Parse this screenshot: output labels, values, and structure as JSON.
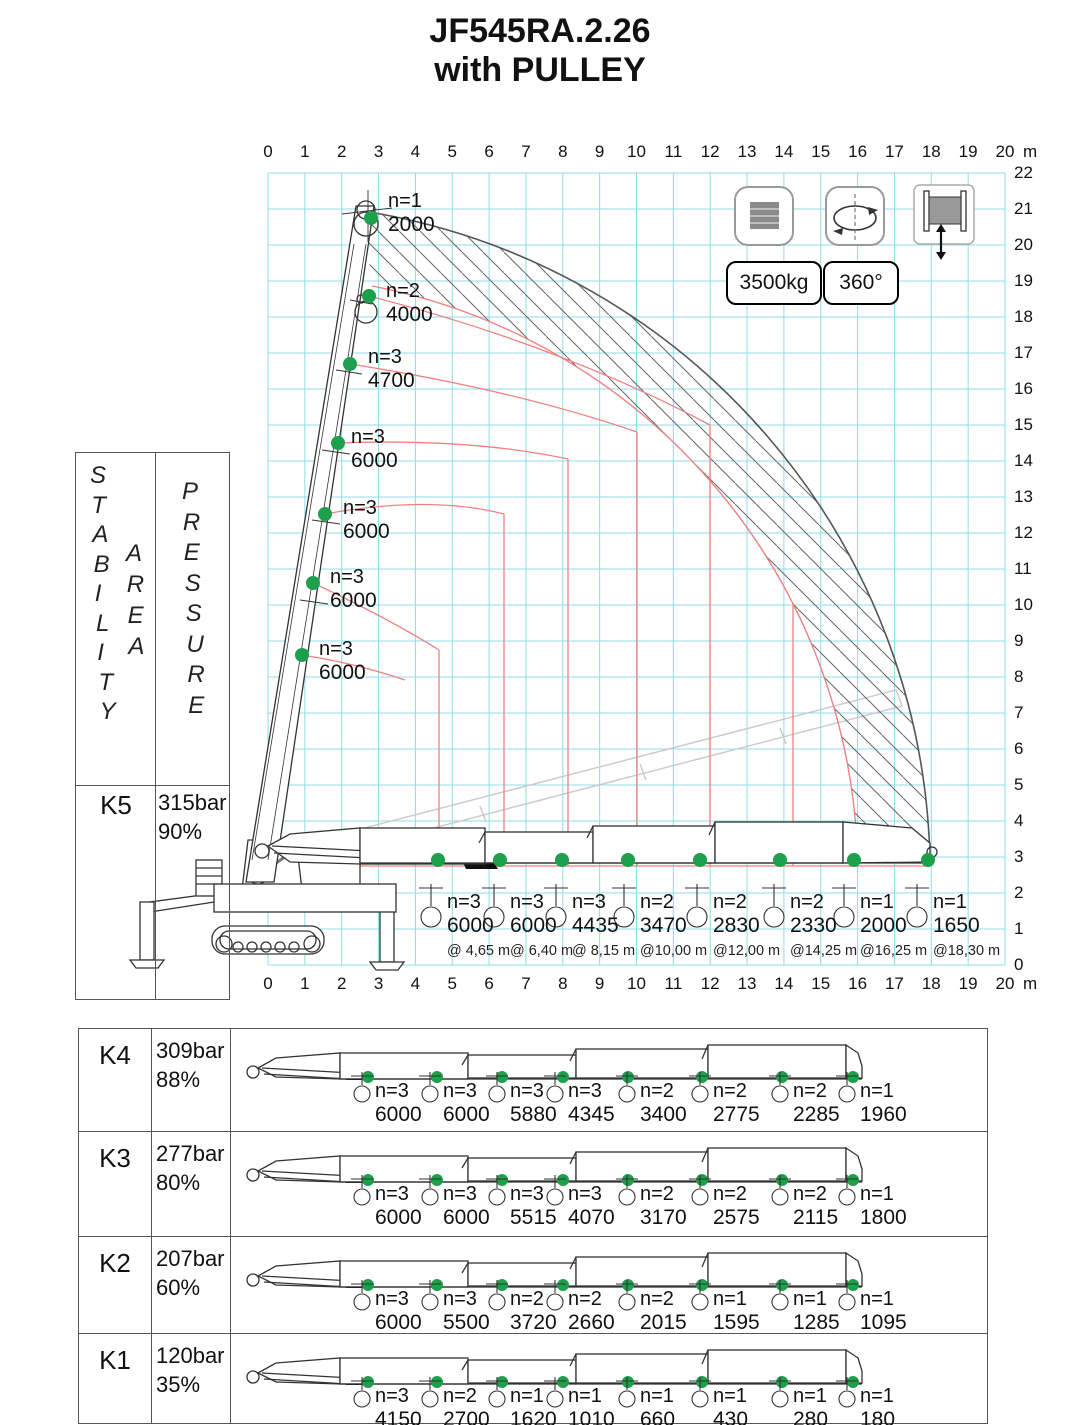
{
  "title": {
    "line1": "JF545RA.2.26",
    "line2": "with PULLEY"
  },
  "badges": {
    "capacity": "3500kg",
    "rotation": "360°"
  },
  "icons": [
    "counterweight-icon",
    "rotation-360-icon",
    "winch-pulley-icon"
  ],
  "axis": {
    "x_unit": "m",
    "x_ticks": [
      "0",
      "1",
      "2",
      "3",
      "4",
      "5",
      "6",
      "7",
      "8",
      "9",
      "10",
      "11",
      "12",
      "13",
      "14",
      "15",
      "16",
      "17",
      "18",
      "19",
      "20"
    ],
    "y_ticks": [
      "0",
      "1",
      "2",
      "3",
      "4",
      "5",
      "6",
      "7",
      "8",
      "9",
      "10",
      "11",
      "12",
      "13",
      "14",
      "15",
      "16",
      "17",
      "18",
      "19",
      "20",
      "21",
      "22"
    ]
  },
  "side_header": {
    "stability": "STABILITY",
    "area": "AREA",
    "pressure": "PRESSURE"
  },
  "vertical_boom_loads": [
    {
      "n": "n=1",
      "load": "2000"
    },
    {
      "n": "n=2",
      "load": "4000"
    },
    {
      "n": "n=3",
      "load": "4700"
    },
    {
      "n": "n=3",
      "load": "6000"
    },
    {
      "n": "n=3",
      "load": "6000"
    },
    {
      "n": "n=3",
      "load": "6000"
    },
    {
      "n": "n=3",
      "load": "6000"
    }
  ],
  "stability_rows": [
    {
      "key": "K5",
      "pressure": "315bar",
      "percent": "90%",
      "loads": [
        {
          "n": "n=3",
          "load": "6000",
          "radius": "@ 4,65 m"
        },
        {
          "n": "n=3",
          "load": "6000",
          "radius": "@ 6,40 m"
        },
        {
          "n": "n=3",
          "load": "4435",
          "radius": "@ 8,15 m"
        },
        {
          "n": "n=2",
          "load": "3470",
          "radius": "@10,00 m"
        },
        {
          "n": "n=2",
          "load": "2830",
          "radius": "@12,00 m"
        },
        {
          "n": "n=2",
          "load": "2330",
          "radius": "@14,25 m"
        },
        {
          "n": "n=1",
          "load": "2000",
          "radius": "@16,25 m"
        },
        {
          "n": "n=1",
          "load": "1650",
          "radius": "@18,30 m"
        }
      ]
    },
    {
      "key": "K4",
      "pressure": "309bar",
      "percent": "88%",
      "loads": [
        {
          "n": "n=3",
          "load": "6000"
        },
        {
          "n": "n=3",
          "load": "6000"
        },
        {
          "n": "n=3",
          "load": "5880"
        },
        {
          "n": "n=3",
          "load": "4345"
        },
        {
          "n": "n=2",
          "load": "3400"
        },
        {
          "n": "n=2",
          "load": "2775"
        },
        {
          "n": "n=2",
          "load": "2285"
        },
        {
          "n": "n=1",
          "load": "1960"
        }
      ]
    },
    {
      "key": "K3",
      "pressure": "277bar",
      "percent": "80%",
      "loads": [
        {
          "n": "n=3",
          "load": "6000"
        },
        {
          "n": "n=3",
          "load": "6000"
        },
        {
          "n": "n=3",
          "load": "5515"
        },
        {
          "n": "n=3",
          "load": "4070"
        },
        {
          "n": "n=2",
          "load": "3170"
        },
        {
          "n": "n=2",
          "load": "2575"
        },
        {
          "n": "n=2",
          "load": "2115"
        },
        {
          "n": "n=1",
          "load": "1800"
        }
      ]
    },
    {
      "key": "K2",
      "pressure": "207bar",
      "percent": "60%",
      "loads": [
        {
          "n": "n=3",
          "load": "6000"
        },
        {
          "n": "n=3",
          "load": "5500"
        },
        {
          "n": "n=2",
          "load": "3720"
        },
        {
          "n": "n=2",
          "load": "2660"
        },
        {
          "n": "n=2",
          "load": "2015"
        },
        {
          "n": "n=1",
          "load": "1595"
        },
        {
          "n": "n=1",
          "load": "1285"
        },
        {
          "n": "n=1",
          "load": "1095"
        }
      ]
    },
    {
      "key": "K1",
      "pressure": "120bar",
      "percent": "35%",
      "loads": [
        {
          "n": "n=3",
          "load": "4150"
        },
        {
          "n": "n=2",
          "load": "2700"
        },
        {
          "n": "n=1",
          "load": "1620"
        },
        {
          "n": "n=1",
          "load": "1010"
        },
        {
          "n": "n=1",
          "load": "660"
        },
        {
          "n": "n=1",
          "load": "430"
        },
        {
          "n": "n=1",
          "load": "280"
        },
        {
          "n": "n=1",
          "load": "180"
        }
      ]
    }
  ],
  "chart_data": {
    "type": "table",
    "title": "JF545RA.2.26 with PULLEY crane load chart",
    "x_axis": {
      "label": "outreach (m)",
      "range": [
        0,
        20
      ]
    },
    "y_axis": {
      "label": "height (m)",
      "range": [
        0,
        22
      ]
    },
    "pulley_capacity_kg": 3500,
    "slew_deg": 360,
    "radii_m": [
      4.65,
      6.4,
      8.15,
      10.0,
      12.0,
      14.25,
      16.25,
      18.3
    ],
    "vertical_boom_loads_kg": [
      2000,
      4000,
      4700,
      6000,
      6000,
      6000,
      6000
    ],
    "vertical_boom_falls": [
      1,
      2,
      3,
      3,
      3,
      3,
      3
    ],
    "rows": [
      {
        "key": "K5",
        "pressure_bar": 315,
        "stability_percent": 90,
        "falls": [
          3,
          3,
          3,
          2,
          2,
          2,
          1,
          1
        ],
        "loads_kg": [
          6000,
          6000,
          4435,
          3470,
          2830,
          2330,
          2000,
          1650
        ]
      },
      {
        "key": "K4",
        "pressure_bar": 309,
        "stability_percent": 88,
        "falls": [
          3,
          3,
          3,
          3,
          2,
          2,
          2,
          1
        ],
        "loads_kg": [
          6000,
          6000,
          5880,
          4345,
          3400,
          2775,
          2285,
          1960
        ]
      },
      {
        "key": "K3",
        "pressure_bar": 277,
        "stability_percent": 80,
        "falls": [
          3,
          3,
          3,
          3,
          2,
          2,
          2,
          1
        ],
        "loads_kg": [
          6000,
          6000,
          5515,
          4070,
          3170,
          2575,
          2115,
          1800
        ]
      },
      {
        "key": "K2",
        "pressure_bar": 207,
        "stability_percent": 60,
        "falls": [
          3,
          3,
          2,
          2,
          2,
          1,
          1,
          1
        ],
        "loads_kg": [
          6000,
          5500,
          3720,
          2660,
          2015,
          1595,
          1285,
          1095
        ]
      },
      {
        "key": "K1",
        "pressure_bar": 120,
        "stability_percent": 35,
        "falls": [
          3,
          2,
          1,
          1,
          1,
          1,
          1,
          1
        ],
        "loads_kg": [
          4150,
          2700,
          1620,
          1010,
          660,
          430,
          280,
          180
        ]
      }
    ]
  }
}
